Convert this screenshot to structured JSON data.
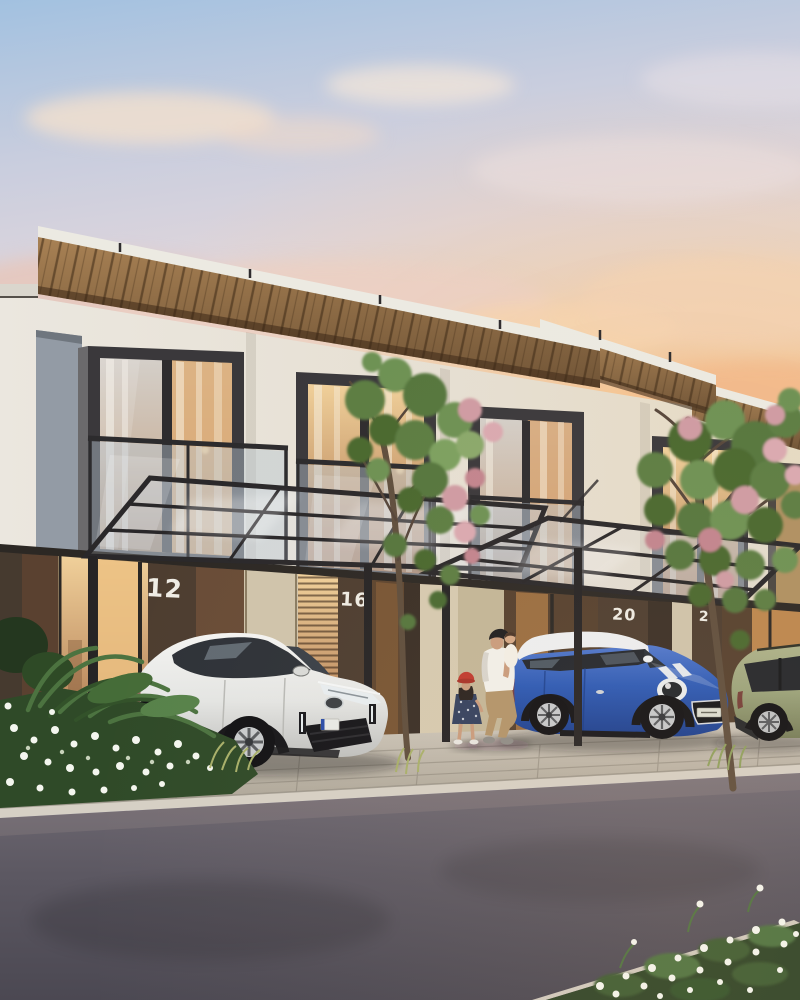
{
  "scene": {
    "type": "architectural exterior rendering",
    "time_of_day": "dusk",
    "subject": "modern two-storey townhouse row with wood roof canopies, glass carports, parked cars, pedestrians and street foreground"
  },
  "houses": [
    {
      "number": "12"
    },
    {
      "number": "16"
    },
    {
      "number": "20"
    },
    {
      "number": "2"
    }
  ],
  "vehicles": [
    {
      "name": "white-crossover-suv",
      "description": "pearl white compact SUV parked under carport",
      "body_color": "#ebebe9"
    },
    {
      "name": "blue-mini-hatchback",
      "description": "blue hatchback with white roof and bonnet stripes",
      "body_color": "#2b59b5",
      "roof_color": "#edeff1"
    },
    {
      "name": "sage-green-suv",
      "description": "sage green crossover at right edge behind tree",
      "body_color": "#9aa37b"
    }
  ],
  "people": [
    {
      "name": "man-carrying-baby",
      "cap_color": "#1e1d1f",
      "shirt_color": "#f2f0ea",
      "pants_color": "#b2946a"
    },
    {
      "name": "baby",
      "wrap_color": "#f3efe6"
    },
    {
      "name": "girl-with-red-hat",
      "hat_color": "#bf3a2e",
      "dress_color": "#34415f"
    }
  ],
  "palette": {
    "sky_top": "#a2c1e0",
    "sky_mid": "#ddd5dc",
    "sky_warm": "#f3d2ac",
    "glow_warm": "#f6c08a",
    "cloud": "#f0dcca",
    "wall_light": "#ebe7df",
    "wall_warm": "#e5dac3",
    "frame_dark": "#3a383b",
    "wood_light": "#a88154",
    "wood_dark": "#6e5234",
    "fascia": "#eceae2",
    "ground_floor_dark": "#463a2f",
    "pier_beige": "#cfc4ab",
    "glass_warm_hi": "#f0d09a",
    "glass_warm_lo": "#a9714a",
    "steel": "#2b292b",
    "pavement": "#c6bfb3",
    "curb": "#d6d0c5",
    "road_top": "#716b74",
    "road_bottom": "#4b4852",
    "foliage_green": "#5c7d42",
    "foliage_dark": "#49682f",
    "blossom_pink": "#cf9ba3"
  }
}
